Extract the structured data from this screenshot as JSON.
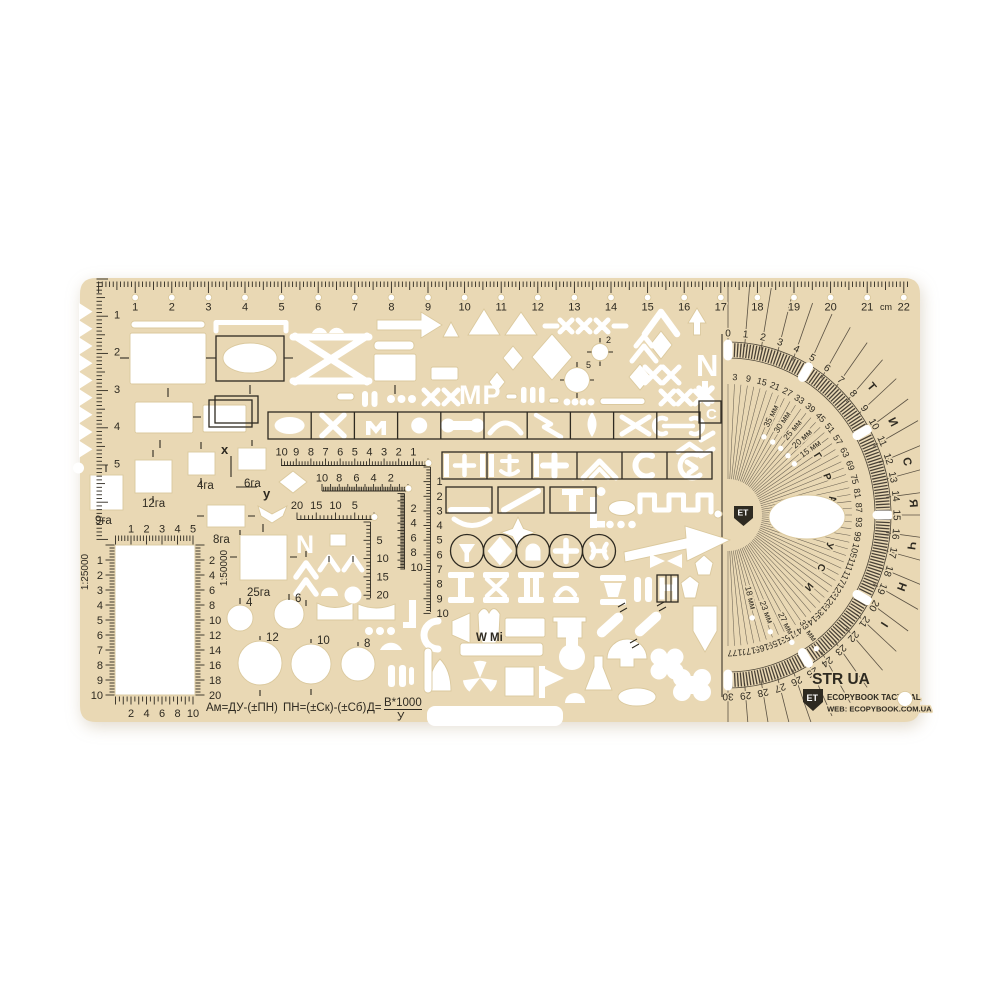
{
  "scene": {
    "description": "Tan plastic tactical drafting stencil template photographed on a white background"
  },
  "colors": {
    "body": "#e9d8b4",
    "body_shadow": "#d9c79b",
    "print": "#2e2a21",
    "cutout": "#ffffff"
  },
  "top_ruler": {
    "unit_label": "cm",
    "numbers": [
      "1",
      "2",
      "3",
      "4",
      "5",
      "6",
      "7",
      "8",
      "9",
      "10",
      "11",
      "12",
      "13",
      "14",
      "15",
      "16",
      "17",
      "18",
      "19",
      "20",
      "21",
      "22"
    ]
  },
  "left_ruler": {
    "numbers": [
      "1",
      "2",
      "3",
      "4",
      "5"
    ]
  },
  "grid_block": {
    "scale_left": "1:25000",
    "scale_right": "1:50000",
    "top_numbers": [
      "1",
      "2",
      "3",
      "4",
      "5"
    ],
    "bottom_numbers": [
      "2",
      "4",
      "6",
      "8",
      "10"
    ],
    "left_numbers": [
      "1",
      "2",
      "3",
      "4",
      "5",
      "6",
      "7",
      "8",
      "9",
      "10"
    ],
    "right_numbers": [
      "2",
      "4",
      "6",
      "8",
      "10",
      "12",
      "14",
      "16",
      "18",
      "20"
    ]
  },
  "coord_scales": {
    "a_horizontal": [
      "10",
      "9",
      "8",
      "7",
      "6",
      "5",
      "4",
      "3",
      "2",
      "1"
    ],
    "a_vertical": [
      "1",
      "2",
      "3",
      "4",
      "5",
      "6",
      "7",
      "8",
      "9",
      "10"
    ],
    "b_horizontal": [
      "10",
      "8",
      "6",
      "4",
      "2"
    ],
    "b_vertical": [
      "2",
      "4",
      "6",
      "8",
      "10"
    ],
    "c_horizontal": [
      "20",
      "15",
      "10",
      "5"
    ],
    "c_vertical": [
      "5",
      "10",
      "15",
      "20"
    ]
  },
  "axis_labels": {
    "x": "x",
    "y": "y"
  },
  "area_labels": {
    "a4": "4га",
    "a6": "6га",
    "a8": "8га",
    "a9": "9га",
    "a12": "12га",
    "a25": "25га"
  },
  "circle_labels": {
    "c4": "4",
    "c6": "6",
    "c12": "12",
    "c10": "10",
    "c8": "8"
  },
  "target_labels": {
    "small": "2",
    "large": "5"
  },
  "cutout_glyphs": {
    "mr": "МР",
    "n_right": "N",
    "n_left": "N",
    "c_boxed": "С"
  },
  "notes": {
    "w_mi": "W Mi"
  },
  "formulas": {
    "azimuth": "Ам=ДУ-(±ПН)",
    "correction": "ПН=(±Ск)-(±Сб)",
    "distance_prefix": "Д=",
    "distance_numerator": "В*1000",
    "distance_denominator": "У"
  },
  "branding": {
    "model": "STR UA",
    "logo": "ET",
    "brand": "ECOPYBOOK TACTICAL",
    "web": "WEB: ECOPYBOOK.COM.UA"
  },
  "protractor": {
    "outer": {
      "start": 0,
      "end": 30,
      "step": 1,
      "word": "ТИСЯЧНІ",
      "letters": [
        "Т",
        "И",
        "С",
        "Я",
        "Ч",
        "Н",
        "І"
      ],
      "letter_positions": [
        8.45,
        10.45,
        12.45,
        14.45,
        16.45,
        18.45,
        20.45
      ]
    },
    "inner": {
      "start": 3,
      "end": 177,
      "step": 6,
      "word": "ГРАДУСИ",
      "letters": [
        "Г",
        "Р",
        "А",
        "Д",
        "У",
        "С",
        "И"
      ],
      "letter_positions": [
        58,
        70,
        82,
        94,
        106,
        118,
        130
      ]
    },
    "mm_upper": [
      {
        "text": "35 мм",
        "deg": 26
      },
      {
        "text": "30 мм",
        "deg": 33
      },
      {
        "text": "25 мм",
        "deg": 40
      },
      {
        "text": "20 мм",
        "deg": 47
      },
      {
        "text": "15 мм",
        "deg": 54
      }
    ],
    "mm_lower": [
      {
        "text": "18 мм",
        "deg": 166,
        "r": 70
      },
      {
        "text": "23 мм",
        "deg": 159,
        "r": 88
      },
      {
        "text": "27 мм",
        "deg": 152,
        "r": 106
      },
      {
        "text": "33 мм",
        "deg": 145,
        "r": 124
      }
    ]
  }
}
